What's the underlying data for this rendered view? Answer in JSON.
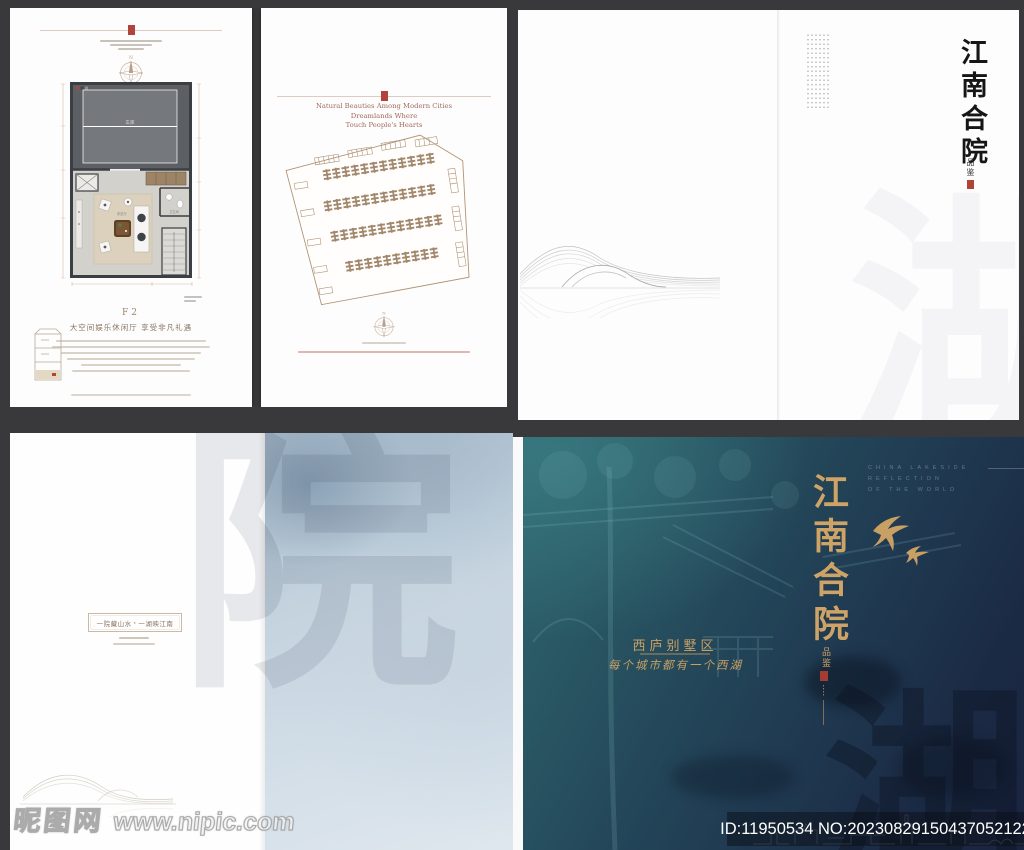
{
  "site": {
    "watermark_name": "昵图网",
    "watermark_url": "www.nipic.com",
    "image_id": "ID:11950534 NO:20230829150437052122"
  },
  "colors": {
    "seal_red": "#b0443a",
    "gold": "#c9a063",
    "teal": "#2a5f6b",
    "navy": "#1a2440",
    "paper": "#fdfdfd",
    "blue_wash": "#c3d2de"
  },
  "floorplan_page": {
    "compass_n": "N",
    "garage_label": "车库",
    "living_label": "家庭厅",
    "bath_label": "卫生间",
    "plan_code": "F2",
    "headline": "大空间娱乐休闲厅 享受非凡礼遇"
  },
  "siteplan_page": {
    "english_lines": [
      "Natural Beauties Among Modern Cities",
      "Dreamlands Where",
      "Touch People's Hearts"
    ],
    "compass_n": "N"
  },
  "white_cover": {
    "title": "江南合院",
    "subtitle": "品鉴",
    "bg_char": "湖"
  },
  "blue_spread": {
    "caption_left": "一院藏山水",
    "caption_sep": "·",
    "caption_right": "一湖映江南",
    "bg_char": "院"
  },
  "dark_cover": {
    "title": "江南合院",
    "subtitle": "品鉴",
    "english_lines": [
      "CHINA LAKESIDE",
      "REFLECTION",
      "OF THE WORLD"
    ],
    "district": "西庐别墅区",
    "slogan": "每个城市都有一个西湖",
    "bg_char": "湖"
  }
}
